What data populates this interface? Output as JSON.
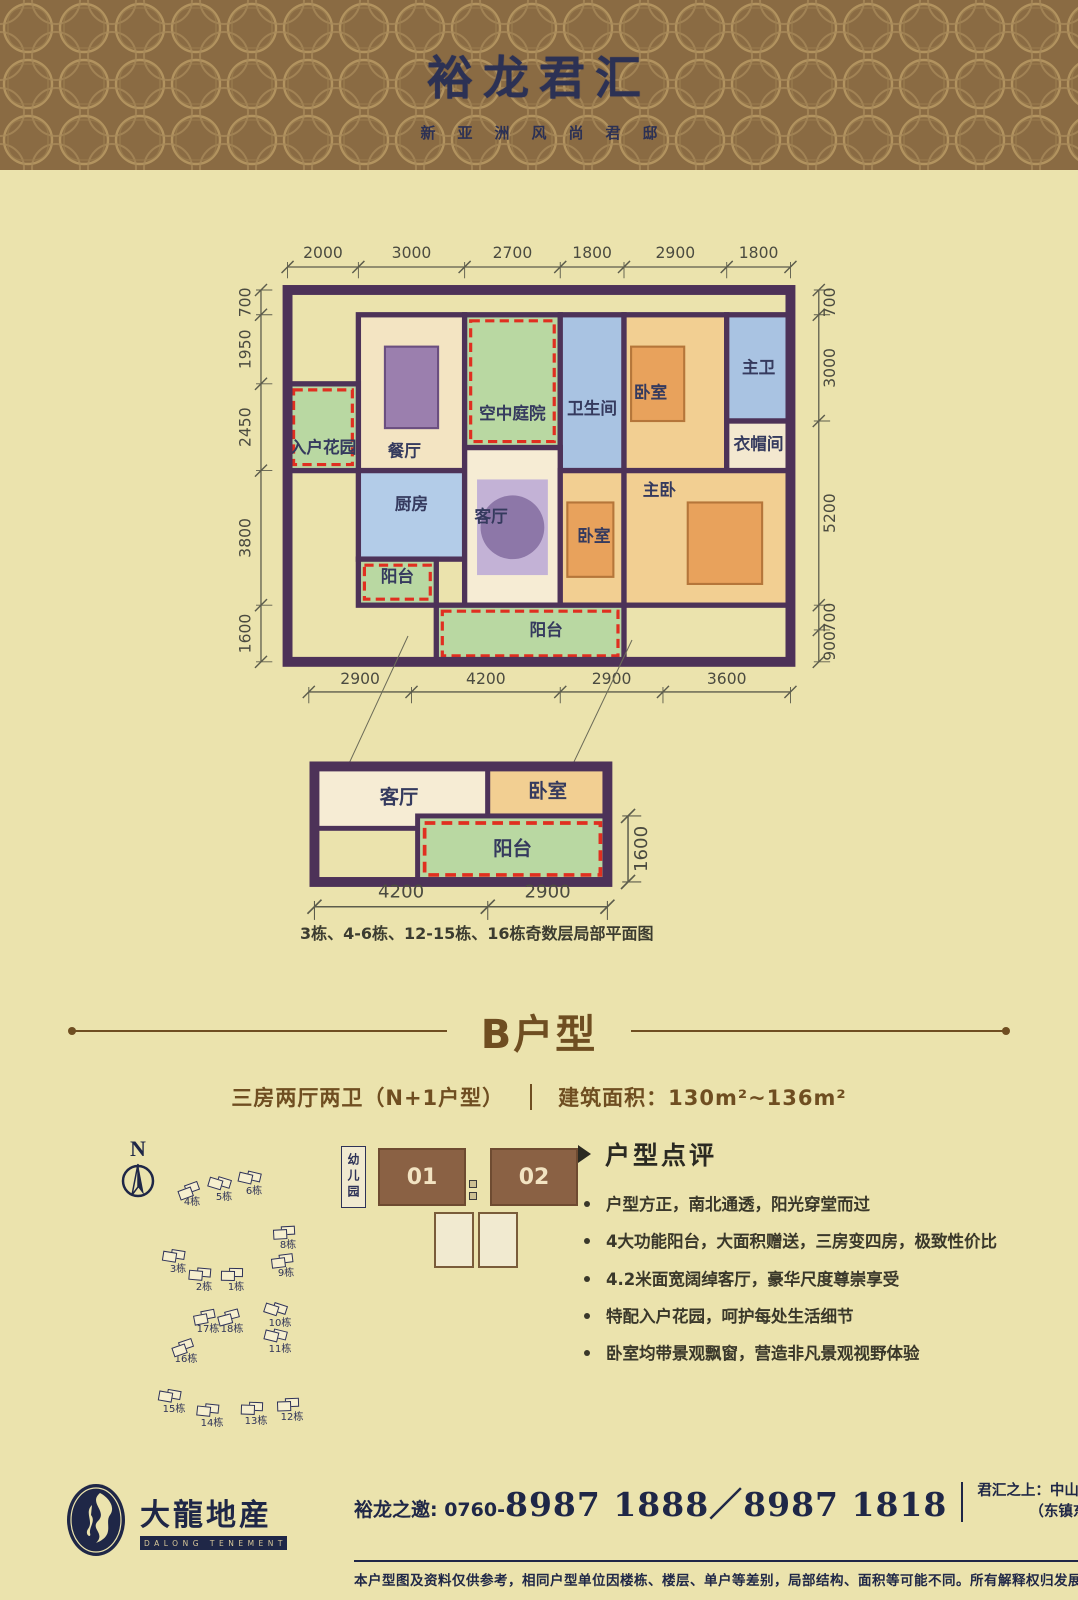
{
  "header": {
    "title": "裕龙君汇",
    "subtitle": "新亚洲风尚君邸"
  },
  "colors": {
    "background": "#ebe3ad",
    "header_brown": "#8a6b43",
    "pattern_gold": "#b99a64",
    "navy": "#2e3257",
    "title_brown": "#6f4e21",
    "wall_purple": "#4d3258",
    "gift_red": "#e02f20",
    "green": "#b9d8a2",
    "blue": "#a9c3e2",
    "orange": "#f2cf92"
  },
  "floorplan": {
    "dims_top": {
      "values": [
        2000,
        3000,
        2700,
        1800,
        2900,
        1800
      ]
    },
    "dims_left": {
      "values": [
        700,
        1950,
        2450,
        3800,
        1600
      ]
    },
    "dims_right": {
      "values": [
        700,
        3000,
        5200,
        700,
        900
      ]
    },
    "dims_bottom": {
      "values": [
        2900,
        4200,
        2900,
        3600
      ]
    },
    "rooms": [
      {
        "name": "dining",
        "label": "餐厅",
        "x": 2000,
        "y": 700,
        "w": 3000,
        "h": 4400,
        "fill": "#f3e4c2",
        "lx": 3300,
        "ly": 4700,
        "furn": "table"
      },
      {
        "name": "sky-courtyard",
        "label": "空中庭院",
        "x": 5000,
        "y": 700,
        "w": 2700,
        "h": 3750,
        "fill": "#b9d8a2",
        "dash": true,
        "lx": 6350,
        "ly": 3650
      },
      {
        "name": "bathroom",
        "label": "卫生间",
        "x": 7700,
        "y": 700,
        "w": 1800,
        "h": 4400,
        "fill": "#a9c3e2",
        "lx": 8600,
        "ly": 3500
      },
      {
        "name": "bedroom-north",
        "label": "卧室",
        "x": 9500,
        "y": 700,
        "w": 2900,
        "h": 4400,
        "fill": "#f2cf92",
        "lx": 10250,
        "ly": 3050,
        "furn": "bed"
      },
      {
        "name": "master-bath",
        "label": "主卫",
        "x": 12400,
        "y": 700,
        "w": 1800,
        "h": 3000,
        "fill": "#a9c3e2",
        "lx": 13300,
        "ly": 2350
      },
      {
        "name": "cloakroom",
        "label": "衣帽间",
        "x": 12400,
        "y": 3700,
        "w": 1800,
        "h": 1400,
        "fill": "#f3e8cf",
        "lx": 13300,
        "ly": 4500
      },
      {
        "name": "entry-garden",
        "label": "入户花园",
        "x": 0,
        "y": 2650,
        "w": 2000,
        "h": 2450,
        "fill": "#b9d8a2",
        "dash": true,
        "lx": 1000,
        "ly": 4600
      },
      {
        "name": "kitchen",
        "label": "厨房",
        "x": 2000,
        "y": 5100,
        "w": 3000,
        "h": 2500,
        "fill": "#b3cce8",
        "lx": 3500,
        "ly": 6200
      },
      {
        "name": "balcony-west",
        "label": "阳台",
        "x": 2000,
        "y": 7600,
        "w": 2200,
        "h": 1300,
        "fill": "#b9d8a2",
        "dash": true,
        "lx": 3100,
        "ly": 8250
      },
      {
        "name": "living",
        "label": "客厅",
        "x": 5000,
        "y": 4450,
        "w": 2700,
        "h": 4450,
        "fill": "#f6ecd4",
        "lx": 5750,
        "ly": 6550,
        "furn": "rug"
      },
      {
        "name": "bedroom-south",
        "label": "卧室",
        "x": 7700,
        "y": 5100,
        "w": 1800,
        "h": 3800,
        "fill": "#f2cf92",
        "lx": 8650,
        "ly": 7100,
        "furn": "bed"
      },
      {
        "name": "master-bedroom",
        "label": "主卧",
        "x": 9500,
        "y": 5100,
        "w": 4700,
        "h": 3800,
        "fill": "#f2cf92",
        "lx": 10500,
        "ly": 5800,
        "furn": "bed2"
      },
      {
        "name": "balcony-south",
        "label": "阳台",
        "x": 4200,
        "y": 8900,
        "w": 5300,
        "h": 1600,
        "fill": "#b9d8a2",
        "dash": true,
        "lx": 7300,
        "ly": 9750
      }
    ]
  },
  "miniplan": {
    "dims_bottom": {
      "values": [
        4200,
        2900
      ]
    },
    "dims_right": {
      "values": [
        1600
      ]
    },
    "rooms": [
      {
        "name": "mini-living",
        "label": "客厅",
        "x": 0,
        "y": 0,
        "w": 4200,
        "h": 1500,
        "fill": "#f6ecd4",
        "lx": 2050,
        "ly": 900
      },
      {
        "name": "mini-bedroom",
        "label": "卧室",
        "x": 4200,
        "y": 0,
        "w": 2900,
        "h": 1200,
        "fill": "#f2cf92",
        "lx": 5650,
        "ly": 750
      },
      {
        "name": "mini-balcony",
        "label": "阳台",
        "x": 2500,
        "y": 1200,
        "w": 4600,
        "h": 1600,
        "fill": "#b9d8a2",
        "dash": true,
        "lx": 4800,
        "ly": 2150
      }
    ]
  },
  "caption": "3栋、4-6栋、12-15栋、16栋奇数层局部平面图",
  "section": {
    "title": "B户型",
    "spec_left": "三房两厅两卫（N+1户型）",
    "spec_right": "建筑面积：130m²~136m²"
  },
  "siteplan": {
    "north_label": "N",
    "kindergarten_label": "幼儿园",
    "buildings": [
      {
        "label": "4栋",
        "x": 100,
        "y": 55
      },
      {
        "label": "5栋",
        "x": 132,
        "y": 50
      },
      {
        "label": "6栋",
        "x": 162,
        "y": 44
      },
      {
        "label": "3栋",
        "x": 86,
        "y": 122
      },
      {
        "label": "2栋",
        "x": 112,
        "y": 140
      },
      {
        "label": "1栋",
        "x": 144,
        "y": 140
      },
      {
        "label": "8栋",
        "x": 196,
        "y": 98
      },
      {
        "label": "9栋",
        "x": 194,
        "y": 126
      },
      {
        "label": "17栋",
        "x": 116,
        "y": 182
      },
      {
        "label": "18栋",
        "x": 140,
        "y": 182
      },
      {
        "label": "16栋",
        "x": 94,
        "y": 212
      },
      {
        "label": "10栋",
        "x": 188,
        "y": 176
      },
      {
        "label": "11栋",
        "x": 188,
        "y": 202
      },
      {
        "label": "15栋",
        "x": 82,
        "y": 262
      },
      {
        "label": "14栋",
        "x": 120,
        "y": 276
      },
      {
        "label": "13栋",
        "x": 164,
        "y": 274
      },
      {
        "label": "12栋",
        "x": 200,
        "y": 270
      }
    ]
  },
  "units": {
    "left": "01",
    "right": "02"
  },
  "review": {
    "title": "户型点评",
    "bullets": [
      "户型方正，南北通透，阳光穿堂而过",
      "4大功能阳台，大面积赠送，三房变四房，极致性价比",
      "4.2米面宽阔绰客厅，豪华尺度尊崇享受",
      "特配入户花园，呵护每处生活细节",
      "卧室均带景观飘窗，营造非凡景观视野体验"
    ]
  },
  "footer": {
    "logo_cn": "大龍地産",
    "logo_en": "DALONG TENEMENT",
    "phone_label": "裕龙之邀: 0760-",
    "phone_numbers": "8987 1888／8987 1818",
    "address_line1": "君汇之上：中山市火炬开发区东阳南路10号",
    "address_line2": "（东镇东一路与东阳南路交汇处）",
    "disclaimer": "本户型图及资料仅供参考，相同户型单位因楼栋、楼层、单户等差别，局部结构、面积等可能不同。所有解释权归发展商所有"
  }
}
